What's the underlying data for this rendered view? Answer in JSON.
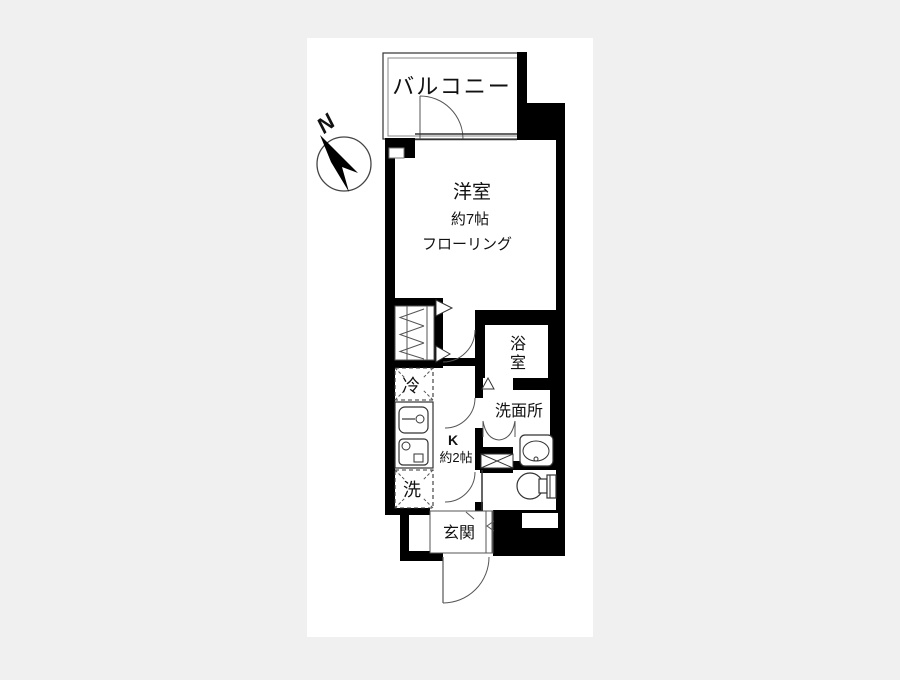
{
  "page": {
    "background": "#f0f0f0",
    "canvas_background": "#ffffff"
  },
  "floorplan": {
    "compass": {
      "north_label": "N"
    },
    "labels": {
      "balcony": "バルコニー",
      "room": "洋室",
      "room_size": "約7帖",
      "room_flooring": "フローリング",
      "bathroom": "浴室",
      "bathroom_chars": [
        "浴",
        "室"
      ],
      "washroom": "洗面所",
      "kitchen": "K",
      "kitchen_size": "約2帖",
      "fridge": "冷",
      "washer": "洗",
      "entrance": "玄関"
    },
    "colors": {
      "wall": "#000000",
      "line": "#333333",
      "thin_line": "#555555",
      "room_fill": "#ffffff"
    }
  }
}
